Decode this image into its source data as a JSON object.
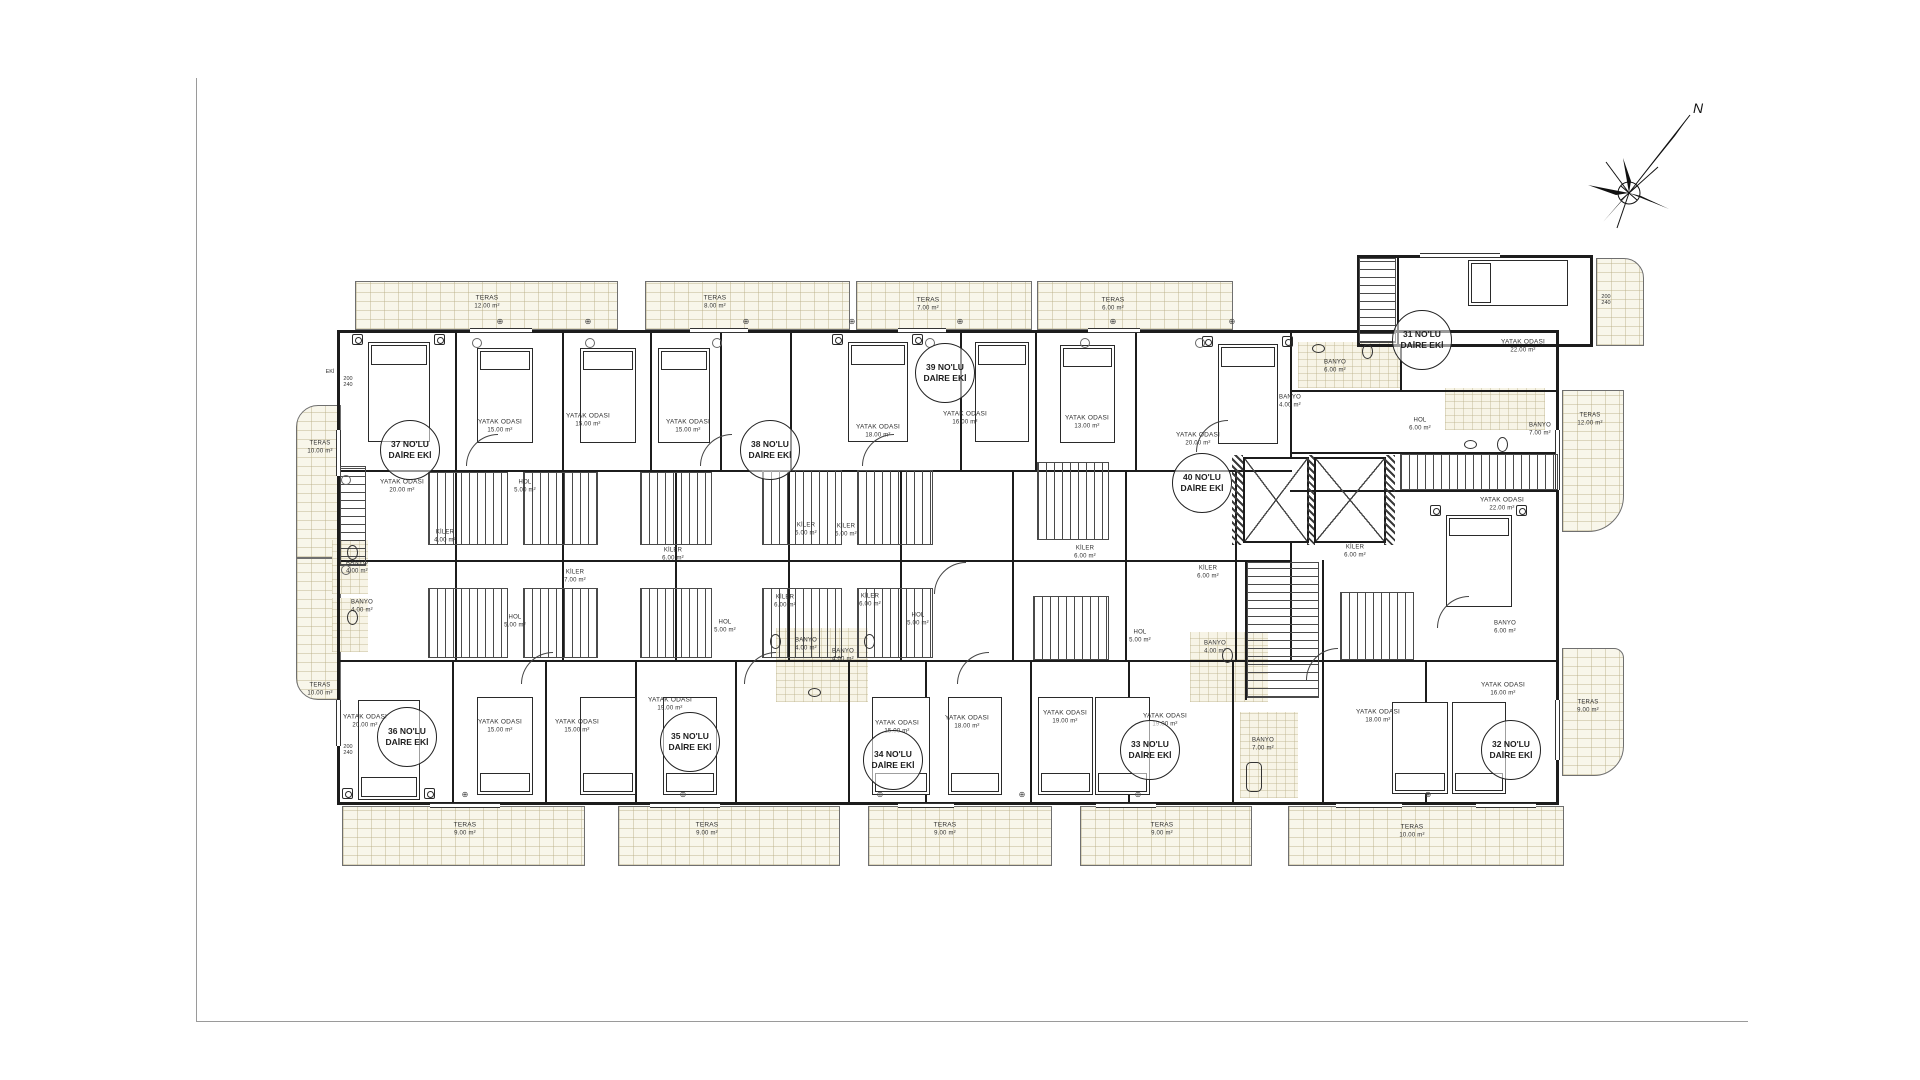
{
  "compass": {
    "north": "N"
  },
  "units": [
    {
      "no": "31 NO'LU",
      "suffix": "DAİRE EKİ"
    },
    {
      "no": "32 NO'LU",
      "suffix": "DAİRE EKİ"
    },
    {
      "no": "33 NO'LU",
      "suffix": "DAİRE EKİ"
    },
    {
      "no": "34 NO'LU",
      "suffix": "DAİRE EKİ"
    },
    {
      "no": "35 NO'LU",
      "suffix": "DAİRE EKİ"
    },
    {
      "no": "36 NO'LU",
      "suffix": "DAİRE EKİ"
    },
    {
      "no": "37 NO'LU",
      "suffix": "DAİRE EKİ"
    },
    {
      "no": "38 NO'LU",
      "suffix": "DAİRE EKİ"
    },
    {
      "no": "39 NO'LU",
      "suffix": "DAİRE EKİ"
    },
    {
      "no": "40 NO'LU",
      "suffix": "DAİRE EKİ"
    }
  ],
  "bedrooms": [
    {
      "name": "YATAK ODASI",
      "area": "20.00 m²"
    },
    {
      "name": "YATAK ODASI",
      "area": "15.00 m²"
    },
    {
      "name": "YATAK ODASI",
      "area": "15.00 m²"
    },
    {
      "name": "YATAK ODASI",
      "area": "15.00 m²"
    },
    {
      "name": "YATAK ODASI",
      "area": "18.00 m²"
    },
    {
      "name": "YATAK ODASI",
      "area": "16.00 m²"
    },
    {
      "name": "YATAK ODASI",
      "area": "13.00 m²"
    },
    {
      "name": "YATAK ODASI",
      "area": "20.00 m²"
    },
    {
      "name": "YATAK ODASI",
      "area": "22.00 m²"
    },
    {
      "name": "YATAK ODASI",
      "area": "22.00 m²"
    },
    {
      "name": "YATAK ODASI",
      "area": "20.00 m²"
    },
    {
      "name": "YATAK ODASI",
      "area": "15.00 m²"
    },
    {
      "name": "YATAK ODASI",
      "area": "15.00 m²"
    },
    {
      "name": "YATAK ODASI",
      "area": "19.00 m²"
    },
    {
      "name": "YATAK ODASI",
      "area": "15.00 m²"
    },
    {
      "name": "YATAK ODASI",
      "area": "18.00 m²"
    },
    {
      "name": "YATAK ODASI",
      "area": "19.00 m²"
    },
    {
      "name": "YATAK ODASI",
      "area": "19.00 m²"
    },
    {
      "name": "YATAK ODASI",
      "area": "18.00 m²"
    },
    {
      "name": "YATAK ODASI",
      "area": "16.00 m²"
    }
  ],
  "terraces": [
    {
      "name": "TERAS",
      "area": "12.00 m²"
    },
    {
      "name": "TERAS",
      "area": "8.00 m²"
    },
    {
      "name": "TERAS",
      "area": "7.00 m²"
    },
    {
      "name": "TERAS",
      "area": "6.00 m²"
    },
    {
      "name": "TERAS",
      "area": "10.00 m²"
    },
    {
      "name": "TERAS",
      "area": "10.00 m²"
    },
    {
      "name": "TERAS",
      "area": "12.00 m²"
    },
    {
      "name": "TERAS",
      "area": "9.00 m²"
    },
    {
      "name": "TERAS",
      "area": "9.00 m²"
    },
    {
      "name": "TERAS",
      "area": "9.00 m²"
    },
    {
      "name": "TERAS",
      "area": "9.00 m²"
    },
    {
      "name": "TERAS",
      "area": "9.00 m²"
    },
    {
      "name": "TERAS",
      "area": "10.00 m²"
    }
  ],
  "halls": [
    {
      "name": "HOL",
      "area": "5.00 m²"
    },
    {
      "name": "HOL",
      "area": "5.00 m²"
    },
    {
      "name": "HOL",
      "area": "5.00 m²"
    },
    {
      "name": "HOL",
      "area": "5.00 m²"
    },
    {
      "name": "HOL",
      "area": "5.00 m²"
    },
    {
      "name": "HOL",
      "area": "6.00 m²"
    }
  ],
  "pantries": [
    {
      "name": "KİLER",
      "area": "4.00 m²"
    },
    {
      "name": "KİLER",
      "area": "7.00 m²"
    },
    {
      "name": "KİLER",
      "area": "6.00 m²"
    },
    {
      "name": "KİLER",
      "area": "5.00 m²"
    },
    {
      "name": "KİLER",
      "area": "5.00 m²"
    },
    {
      "name": "KİLER",
      "area": "6.00 m²"
    },
    {
      "name": "KİLER",
      "area": "6.00 m²"
    },
    {
      "name": "KİLER",
      "area": "6.00 m²"
    },
    {
      "name": "KİLER",
      "area": "6.00 m²"
    },
    {
      "name": "KİLER",
      "area": "6.00 m²"
    }
  ],
  "baths": [
    {
      "name": "BANYO",
      "area": "4.00 m²"
    },
    {
      "name": "BANYO",
      "area": "4.00 m²"
    },
    {
      "name": "BANYO",
      "area": "4.00 m²"
    },
    {
      "name": "BANYO",
      "area": "4.00 m²"
    },
    {
      "name": "BANYO",
      "area": "4.00 m²"
    },
    {
      "name": "BANYO",
      "area": "7.00 m²"
    },
    {
      "name": "BANYO",
      "area": "4.00 m²"
    },
    {
      "name": "BANYO",
      "area": "6.00 m²"
    },
    {
      "name": "BANYO",
      "area": "6.00 m²"
    },
    {
      "name": "BANYO",
      "area": "7.00 m²"
    }
  ],
  "tags": {
    "eki": "EKİ",
    "dim1": "200",
    "dim2": "240"
  },
  "symbols": {
    "vent": "⊕"
  }
}
